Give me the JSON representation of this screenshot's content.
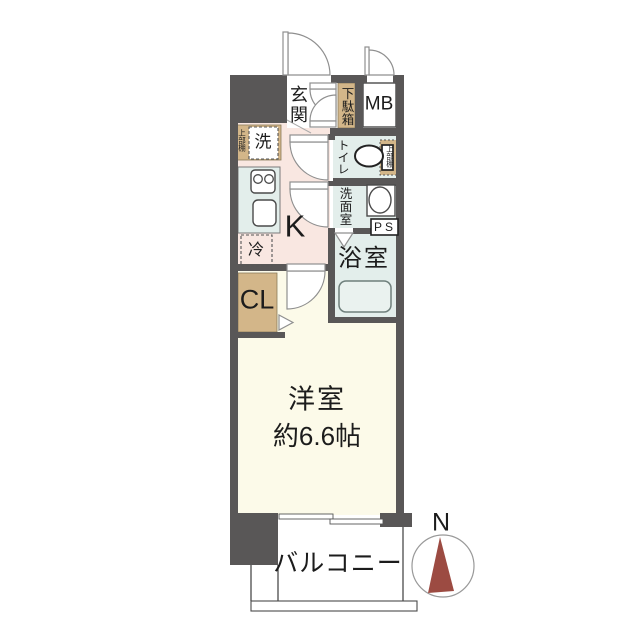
{
  "floor_plan": {
    "labels": {
      "genkan": "玄関",
      "shoe_cabinet": "下駄箱",
      "meter_box": "MB",
      "upper_shelf_entry": "上部棚",
      "washer": "洗",
      "toilet": "トイレ",
      "upper_shelf_toilet": "上部棚",
      "washroom": "洗面室",
      "pipe_space": "PS",
      "bathroom": "浴室",
      "kitchen": "K",
      "fridge": "冷",
      "closet": "CL",
      "main_room": "洋室",
      "main_room_size": "約6.6帖",
      "balcony": "バルコニー",
      "compass_north": "N"
    },
    "colors": {
      "wall": "#595757",
      "kitchen_floor": "#f9e7e1",
      "main_room_floor": "#fcfae9",
      "wet_area_floor": "#e3eeeb",
      "cabinet": "#d3b689",
      "compass_needle": "#9c4b42"
    }
  }
}
